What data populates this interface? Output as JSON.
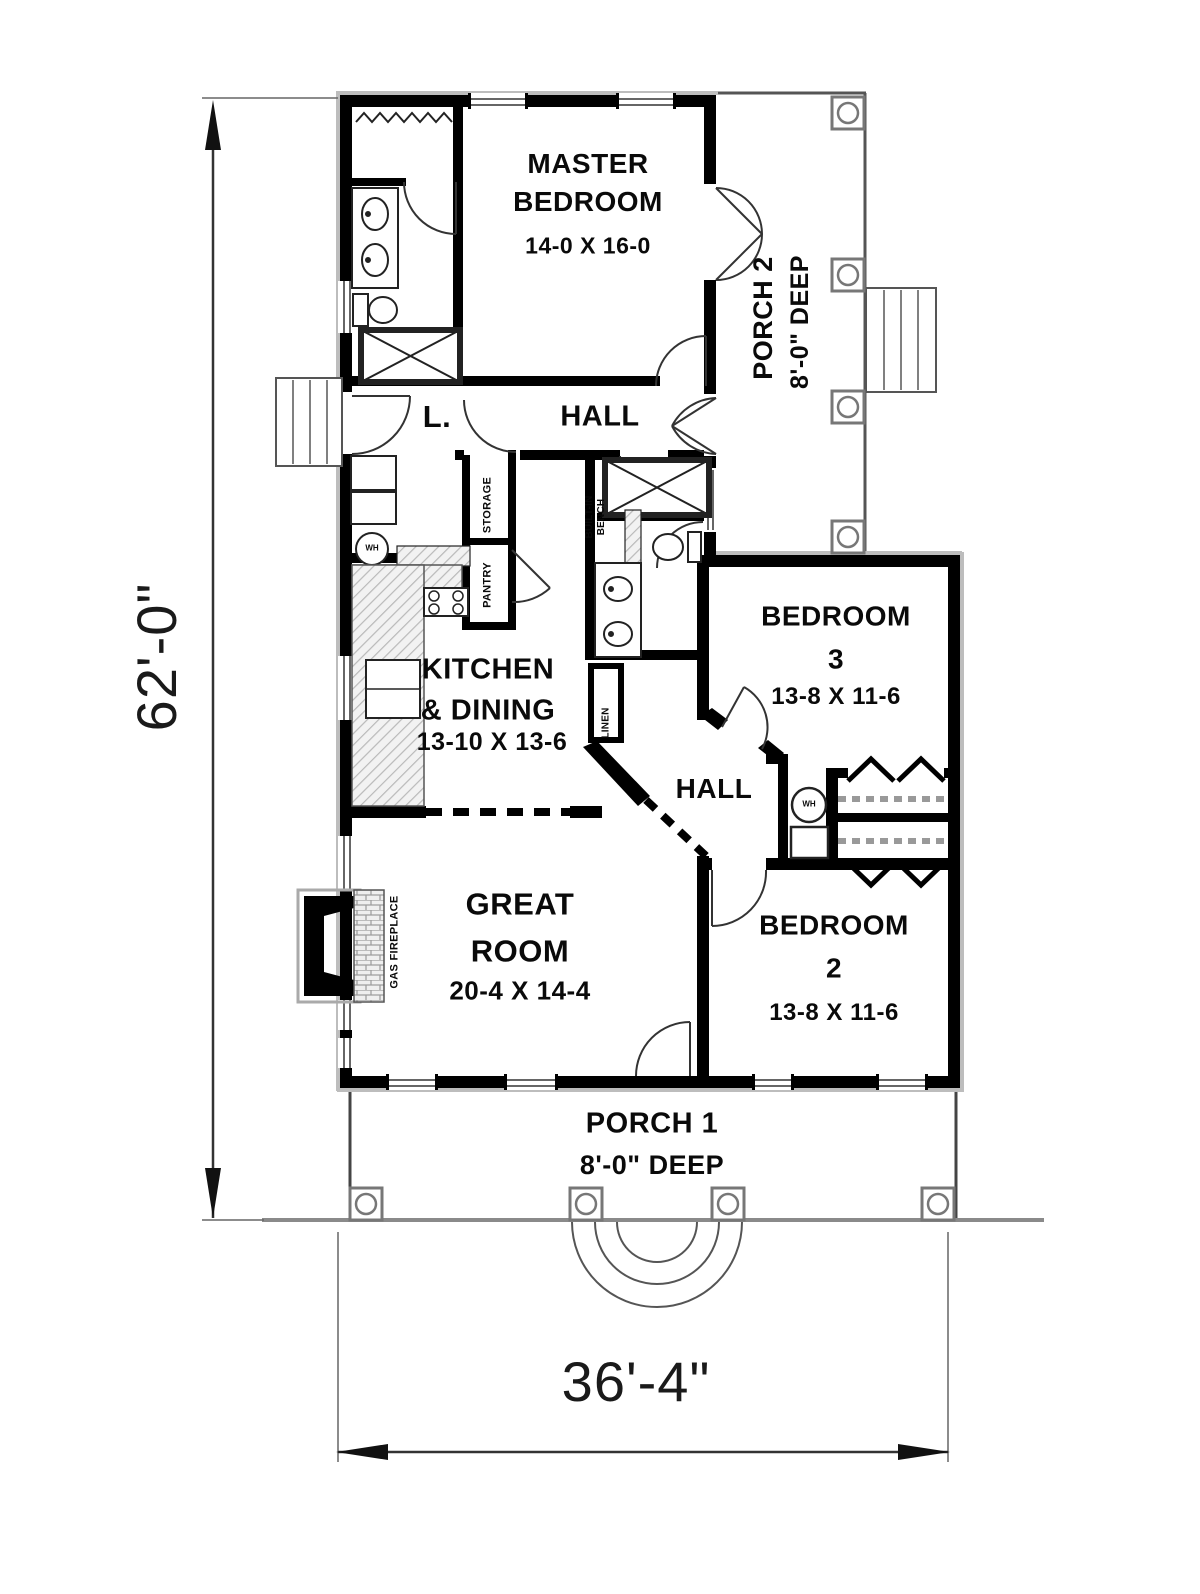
{
  "plan_title": "Single-story house floor plan",
  "dimensions": {
    "overall_height": "62'-0\"",
    "overall_width": "36'-4\""
  },
  "rooms": {
    "master_bedroom": {
      "name": "MASTER\nBEDROOM",
      "size": "14-0 X 16-0"
    },
    "porch2": {
      "name": "PORCH 2",
      "depth": "8'-0\" DEEP"
    },
    "hall_upper": {
      "name": "HALL"
    },
    "laundry": {
      "name": "L."
    },
    "storage": {
      "name": "STORAGE"
    },
    "pantry": {
      "name": "PANTRY"
    },
    "built_in_bench": {
      "name": "BUILT-IN\nBENCH"
    },
    "kitchen_dining": {
      "name": "KITCHEN\n& DINING",
      "size": "13-10 X 13-6"
    },
    "linen": {
      "name": "LINEN"
    },
    "bedroom3": {
      "name": "BEDROOM\n3",
      "size": "13-8 X 11-6"
    },
    "hall_lower": {
      "name": "HALL"
    },
    "great_room": {
      "name": "GREAT\nROOM",
      "size": "20-4 X 14-4"
    },
    "gas_fireplace": {
      "name": "GAS FIREPLACE"
    },
    "bedroom2": {
      "name": "BEDROOM\n2",
      "size": "13-8 X 11-6"
    },
    "porch1": {
      "name": "PORCH 1",
      "depth": "8'-0\" DEEP"
    },
    "water_heater_laundry": {
      "abbr": "WH"
    },
    "water_heater_hall": {
      "abbr": "WH"
    }
  },
  "colors": {
    "wall": "#000000",
    "edge_gray": "#9a9a9a",
    "hatch_gray": "#c9c9c9",
    "background": "#ffffff",
    "text": "#0a0a0a"
  }
}
